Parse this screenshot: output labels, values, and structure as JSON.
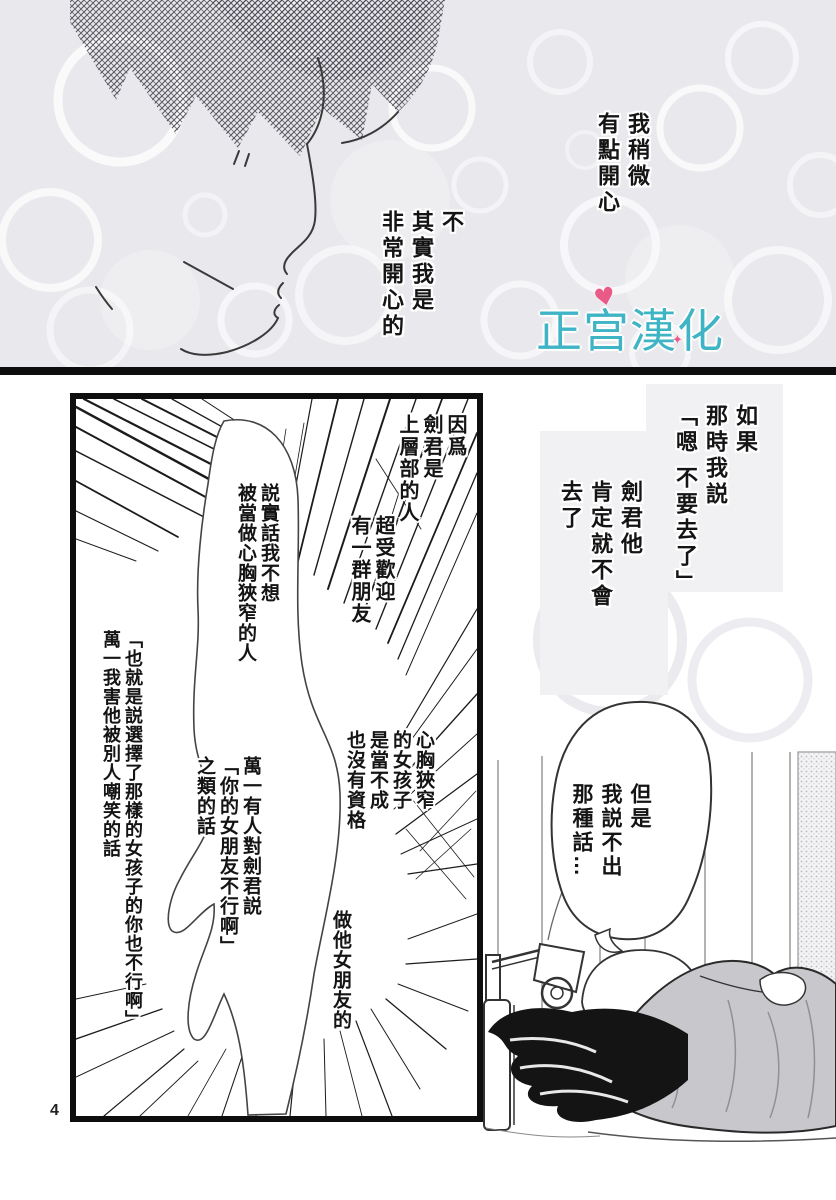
{
  "page_number": "4",
  "colors": {
    "logo_teal": "#3fb4c5",
    "logo_pink": "#ea5a87",
    "panel_border": "#0e0e0e",
    "screentone_grey": "#c8c8cc",
    "top_panel_bg": "#e9e9ed",
    "narration_box_grey": "#f1f1f4"
  },
  "logo": {
    "text": "正宫漢化組",
    "heart_icon": "♥",
    "sparkle_icon": "✦"
  },
  "top_panel": {
    "narration_slightly_happy": {
      "columns": [
        "我稍微",
        "有點開心"
      ]
    },
    "narration_actually_happy": {
      "columns": [
        "不",
        "其實我是",
        "非常開心的"
      ]
    }
  },
  "main_section": {
    "narration_if_said": {
      "columns": [
        "如果",
        "那時我説",
        "「嗯 不要去了」"
      ]
    },
    "narration_ken_wouldnt_go": {
      "columns": [
        "劍君他",
        "肯定就不會",
        "去了"
      ]
    },
    "panel": {
      "narration_because": {
        "columns": [
          "因爲",
          "劍君是",
          "上層部的人"
        ]
      },
      "narration_popular": {
        "columns": [
          "超受歡迎",
          "有一群朋友"
        ]
      },
      "bubble_honestly": {
        "columns": [
          "説實話我不想",
          "被當做心胸狹窄的人"
        ]
      },
      "narration_that_is": {
        "columns": [
          "「也就是説選擇了那樣的女孩子的你也不行啊」",
          "萬一我害他被別人嘲笑的話"
        ]
      },
      "narration_narrow_minded": {
        "columns": [
          "心胸狹窄",
          "的女孩子",
          "是當不成",
          "也沒有資格"
        ]
      },
      "bubble_if_someone": {
        "columns": [
          "萬一有人對劍君説",
          "「你的女朋友不行啊」",
          "之類的話"
        ]
      },
      "narration_his_girlfriend": {
        "columns": [
          "做他女朋友的"
        ]
      }
    },
    "bubble_but": {
      "columns": [
        "但是",
        "我説不出",
        "那種話…"
      ]
    }
  }
}
